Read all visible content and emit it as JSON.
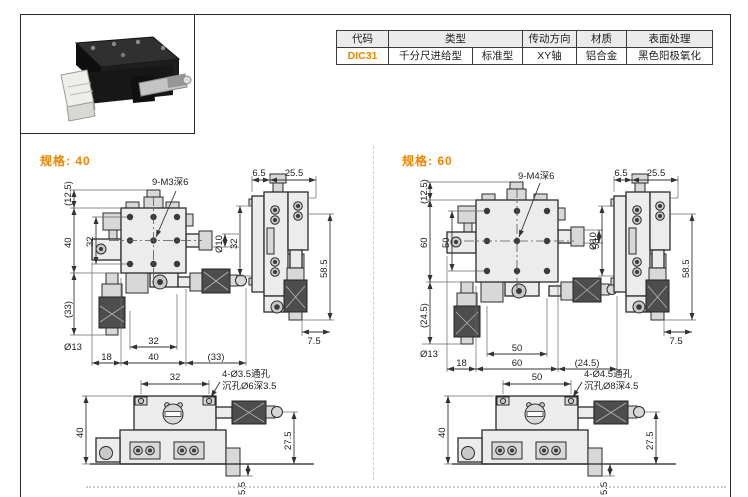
{
  "colors": {
    "accent": "#f08300"
  },
  "header_table": {
    "col_code": "代码",
    "col_type": "类型",
    "col_drive": "传动方向",
    "col_material": "材质",
    "col_finish": "表面处理",
    "code": "DIC31",
    "type_main": "千分尺进给型",
    "type_sub": "标准型",
    "drive": "XY轴",
    "material": "铝合金",
    "finish": "黑色阳极氧化"
  },
  "specs": [
    {
      "title": "规格: 40",
      "front": {
        "thread_note": "9-M3深6",
        "dim_knob": "(12.5)",
        "dim_height": "40",
        "dim_hole_v": "32",
        "dim_lower": "(33)",
        "dia_shaft": "Ø10",
        "dia_knurl": "Ø13",
        "dim_hole_h": "32",
        "dim_left": "18",
        "dim_width": "40",
        "dim_right": "(33)"
      },
      "side": {
        "dim_offset": "6.5",
        "dim_top": "25.5",
        "dim_holes": "32",
        "dim_height": "58.5",
        "dim_foot": "7.5"
      },
      "bottom": {
        "dim_holes": "32",
        "note_hole": "4-Ø3.5通孔",
        "note_cbore": "沉孔Ø6深3.5",
        "dim_height": "40",
        "dim_mic": "27.5",
        "dim_foot": "5.5"
      }
    },
    {
      "title": "规格: 60",
      "front": {
        "thread_note": "9-M4深6",
        "dim_knob": "(12.5)",
        "dim_height": "60",
        "dim_hole_v": "50",
        "dim_lower": "(24.5)",
        "dia_shaft": "Ø10",
        "dia_knurl": "Ø13",
        "dim_hole_h": "50",
        "dim_left": "18",
        "dim_width": "60",
        "dim_right": "(24.5)"
      },
      "side": {
        "dim_offset": "6.5",
        "dim_top": "25.5",
        "dim_holes": "50",
        "dim_height": "58.5",
        "dim_foot": "7.5"
      },
      "bottom": {
        "dim_holes": "50",
        "note_hole": "4-Ø4.5通孔",
        "note_cbore": "沉孔Ø8深4.5",
        "dim_height": "40",
        "dim_mic": "27.5",
        "dim_foot": "5.5"
      }
    }
  ]
}
